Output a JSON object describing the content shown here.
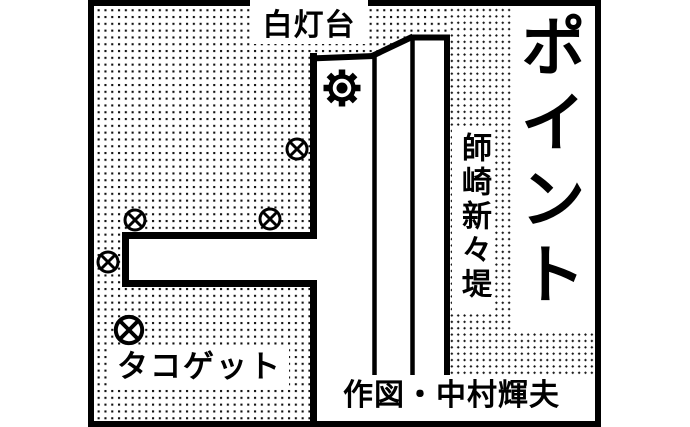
{
  "map": {
    "description": "Hand-drawn fishing point map of a breakwater",
    "title_vertical": "ポイント",
    "lighthouse_label": "白灯台",
    "breakwater_label": "師崎新々堤",
    "spot_note_label": "タコゲット",
    "credit_label": "作図・中村輝夫",
    "markers": {
      "fishing_spot_symbol": "circled-x",
      "fishing_spot_count": 5
    },
    "icons": {
      "lighthouse": "lighthouse-beacon-icon"
    },
    "colors": {
      "ink": "#000000",
      "paper": "#ffffff"
    }
  }
}
